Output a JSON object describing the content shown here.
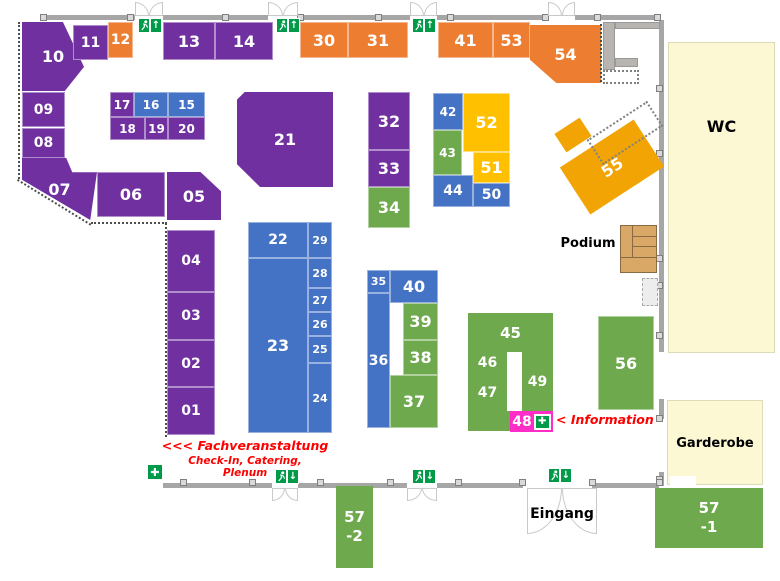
{
  "booths": {
    "b01": "01",
    "b02": "02",
    "b03": "03",
    "b04": "04",
    "b05": "05",
    "b06": "06",
    "b07": "07",
    "b08": "08",
    "b09": "09",
    "b10": "10",
    "b11": "11",
    "b12": "12",
    "b13": "13",
    "b14": "14",
    "b15": "15",
    "b16": "16",
    "b17": "17",
    "b18": "18",
    "b19": "19",
    "b20": "20",
    "b21": "21",
    "b22": "22",
    "b23": "23",
    "b24": "24",
    "b25": "25",
    "b26": "26",
    "b27": "27",
    "b28": "28",
    "b29": "29",
    "b30": "30",
    "b31": "31",
    "b32": "32",
    "b33": "33",
    "b34": "34",
    "b35": "35",
    "b36": "36",
    "b37": "37",
    "b38": "38",
    "b39": "39",
    "b40": "40",
    "b41": "41",
    "b42": "42",
    "b43": "43",
    "b44": "44",
    "b45": "45",
    "b46": "46",
    "b47": "47",
    "b48": "48",
    "b49": "49",
    "b50": "50",
    "b51": "51",
    "b52": "52",
    "b53": "53",
    "b54": "54",
    "b55": "55",
    "b56": "56",
    "b57_1a": "57",
    "b57_1b": "-1",
    "b57_2a": "57",
    "b57_2b": "-2"
  },
  "rooms": {
    "wc": "WC",
    "garderobe": "Garderobe"
  },
  "labels": {
    "podium": "Podium",
    "eingang": "Eingang"
  },
  "annotations": {
    "fachveranstaltung": "<<< Fachveranstaltung",
    "checkin": "Check-In, Catering, Plenum",
    "information": "< Information"
  },
  "icons": {
    "arrow_up": "↑",
    "arrow_down": "↓",
    "first_aid_cross": "✚",
    "exit_man": "exit-running-man"
  },
  "colors": {
    "booth_purple": "#7030A0",
    "booth_orange": "#ED7D31",
    "booth_blue": "#4472C4",
    "booth_green": "#6FA94D",
    "booth_yellow": "#FFC000",
    "booth_amber": "#F2A405",
    "booth_pink": "#FF2DC8",
    "room_cream": "#FBF8D3",
    "podium_wood": "#D9A866",
    "wall_gray": "#A6A6A6",
    "exit_green": "#009A49",
    "note_red": "#FF0000"
  }
}
